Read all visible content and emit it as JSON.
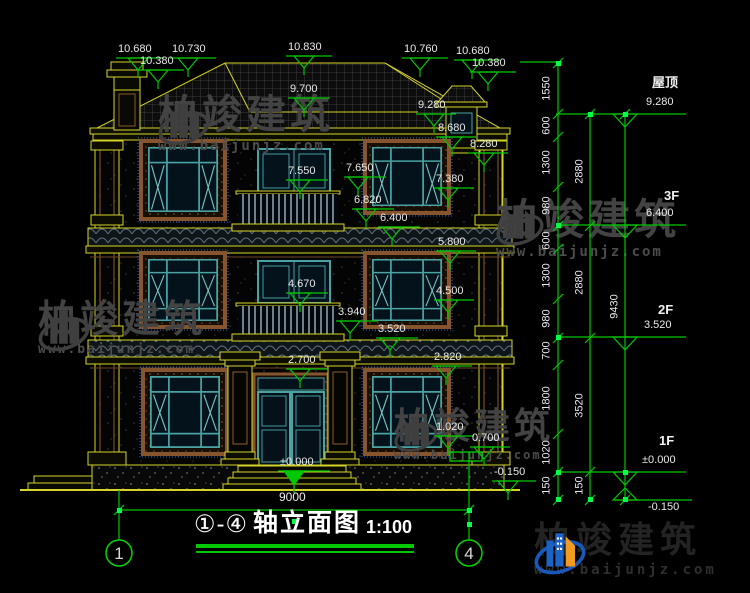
{
  "colors": {
    "background": "#000000",
    "cad_yellow": "#d4d42a",
    "dimension_green": "#00c800",
    "grip_green": "#00ff48",
    "text_white": "#e9e9e9",
    "window_teal": "#49a3a3",
    "surround_brown": "#86552e",
    "watermark_gray": "#434343",
    "logo_blue": "#1b63c4",
    "logo_orange": "#f19b22"
  },
  "title": {
    "axes": "①-④",
    "text": "轴立面图",
    "scale": "1:100"
  },
  "axis_bubbles": [
    {
      "label": "1"
    },
    {
      "label": "4"
    }
  ],
  "watermarks": {
    "brand": "柏竣建筑",
    "url": "www.baijunjz.com"
  },
  "right_levels": [
    {
      "floor": "屋顶",
      "elevation": "9.280"
    },
    {
      "floor": "3F",
      "elevation": "6.400"
    },
    {
      "floor": "2F",
      "elevation": "3.520"
    },
    {
      "floor": "1F",
      "elevation": "±0.000"
    },
    {
      "floor": "",
      "elevation": "-0.150"
    }
  ],
  "markers": [
    {
      "t": "10.680",
      "x": 116,
      "y": 58,
      "w": 48,
      "tb": 12,
      "s": false
    },
    {
      "t": "10.380",
      "x": 138,
      "y": 70,
      "w": 46,
      "tb": 10,
      "s": false
    },
    {
      "t": "10.730",
      "x": 170,
      "y": 58,
      "w": 46,
      "tb": 8,
      "s": false
    },
    {
      "t": "10.830",
      "x": 286,
      "y": 56,
      "w": 46,
      "tb": 8,
      "s": false
    },
    {
      "t": "9.700",
      "x": 288,
      "y": 98,
      "w": 42,
      "tb": 6,
      "s": false
    },
    {
      "t": "10.760",
      "x": 402,
      "y": 58,
      "w": 46,
      "tb": 8,
      "s": false
    },
    {
      "t": "10.680",
      "x": 454,
      "y": 60,
      "w": 46,
      "tb": 8,
      "s": false
    },
    {
      "t": "10.380",
      "x": 470,
      "y": 72,
      "w": 46,
      "tb": 8,
      "s": false
    },
    {
      "t": "9.280",
      "x": 416,
      "y": 114,
      "w": 40,
      "tb": 8,
      "s": false
    },
    {
      "t": "8.680",
      "x": 436,
      "y": 137,
      "w": 40,
      "tb": 6,
      "s": false
    },
    {
      "t": "8.280",
      "x": 468,
      "y": 153,
      "w": 40,
      "tb": 6,
      "s": false
    },
    {
      "t": "7.550",
      "x": 286,
      "y": 180,
      "w": 42,
      "tb": 4,
      "s": false
    },
    {
      "t": "7.650",
      "x": 344,
      "y": 177,
      "w": 42,
      "tb": 4,
      "s": false
    },
    {
      "t": "7.380",
      "x": 434,
      "y": 188,
      "w": 40,
      "tb": 4,
      "s": false
    },
    {
      "t": "6.820",
      "x": 352,
      "y": 209,
      "w": 42,
      "tb": 4,
      "s": false
    },
    {
      "t": "6.400",
      "x": 378,
      "y": 227,
      "w": 42,
      "tb": 4,
      "s": false
    },
    {
      "t": "5.800",
      "x": 436,
      "y": 251,
      "w": 40,
      "tb": 4,
      "s": false
    },
    {
      "t": "4.670",
      "x": 286,
      "y": 293,
      "w": 42,
      "tb": 4,
      "s": false
    },
    {
      "t": "4.500",
      "x": 434,
      "y": 300,
      "w": 40,
      "tb": 4,
      "s": false
    },
    {
      "t": "3.940",
      "x": 336,
      "y": 321,
      "w": 42,
      "tb": 4,
      "s": false
    },
    {
      "t": "3.520",
      "x": 376,
      "y": 338,
      "w": 42,
      "tb": 4,
      "s": false
    },
    {
      "t": "2.700",
      "x": 286,
      "y": 369,
      "w": 42,
      "tb": 4,
      "s": false
    },
    {
      "t": "2.820",
      "x": 432,
      "y": 366,
      "w": 40,
      "tb": 4,
      "s": false
    },
    {
      "t": "1.020",
      "x": 434,
      "y": 436,
      "w": 40,
      "tb": 4,
      "s": false
    },
    {
      "t": "0.700",
      "x": 470,
      "y": 447,
      "w": 40,
      "tb": 4,
      "s": false
    },
    {
      "t": "±0.000",
      "x": 278,
      "y": 471,
      "w": 52,
      "tb": 6,
      "s": true
    },
    {
      "t": "-0.150",
      "x": 492,
      "y": 481,
      "w": 44,
      "tb": 6,
      "s": false
    }
  ],
  "labels": [
    {
      "t": "屋顶",
      "x": 652,
      "y": 76,
      "c": "floor"
    },
    {
      "t": "9.280",
      "x": 646,
      "y": 97,
      "c": "dim"
    },
    {
      "t": "3F",
      "x": 664,
      "y": 189,
      "c": "floor"
    },
    {
      "t": "6.400",
      "x": 646,
      "y": 208,
      "c": "dim"
    },
    {
      "t": "2F",
      "x": 658,
      "y": 303,
      "c": "floor"
    },
    {
      "t": "3.520",
      "x": 644,
      "y": 320,
      "c": "dim"
    },
    {
      "t": "1F",
      "x": 659,
      "y": 434,
      "c": "floor"
    },
    {
      "t": "±0.000",
      "x": 642,
      "y": 455,
      "c": "dim"
    },
    {
      "t": "-0.150",
      "x": 648,
      "y": 502,
      "c": "dim"
    },
    {
      "t": "1550",
      "x": 547,
      "y": 89,
      "c": "chain"
    },
    {
      "t": "600",
      "x": 547,
      "y": 126,
      "c": "chain"
    },
    {
      "t": "1300",
      "x": 547,
      "y": 163,
      "c": "chain"
    },
    {
      "t": "980",
      "x": 547,
      "y": 206,
      "c": "chain"
    },
    {
      "t": "600",
      "x": 547,
      "y": 241,
      "c": "chain"
    },
    {
      "t": "1300",
      "x": 547,
      "y": 276,
      "c": "chain"
    },
    {
      "t": "980",
      "x": 547,
      "y": 319,
      "c": "chain"
    },
    {
      "t": "700",
      "x": 547,
      "y": 351,
      "c": "chain"
    },
    {
      "t": "1800",
      "x": 547,
      "y": 399,
      "c": "chain"
    },
    {
      "t": "1020",
      "x": 547,
      "y": 453,
      "c": "chain"
    },
    {
      "t": "150",
      "x": 547,
      "y": 486,
      "c": "chain"
    },
    {
      "t": "2880",
      "x": 580,
      "y": 172,
      "c": "chain"
    },
    {
      "t": "2880",
      "x": 580,
      "y": 283,
      "c": "chain"
    },
    {
      "t": "3520",
      "x": 580,
      "y": 406,
      "c": "chain"
    },
    {
      "t": "150",
      "x": 580,
      "y": 486,
      "c": "chain"
    },
    {
      "t": "9430",
      "x": 615,
      "y": 307,
      "c": "chain"
    },
    {
      "t": "9000",
      "x": 279,
      "y": 491,
      "c": "dimLg"
    }
  ]
}
